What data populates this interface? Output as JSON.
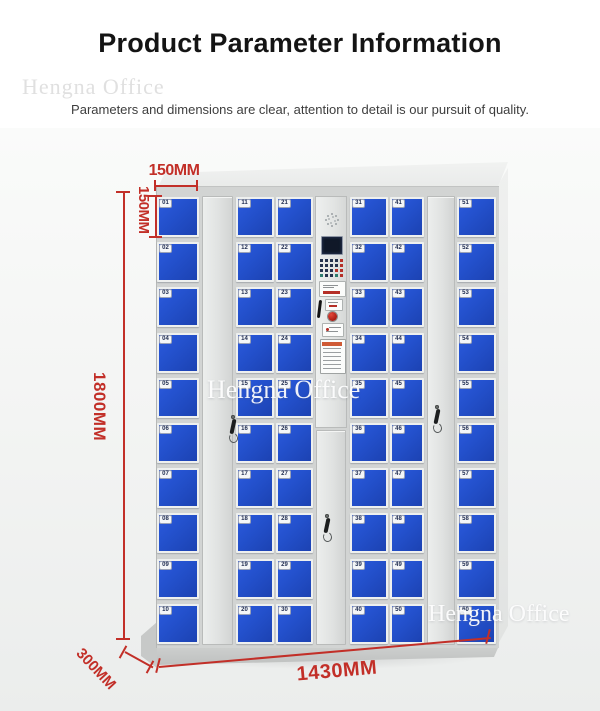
{
  "header": {
    "title": "Product Parameter Information",
    "subtitle": "Parameters and dimensions are clear, attention to detail is our pursuit of quality."
  },
  "watermarks": {
    "top_left": "Hengna Office",
    "center": "Hengna Office",
    "bottom_right": "Hengna Office"
  },
  "dimensions": {
    "door_width": "150MM",
    "door_height": "150MM",
    "height": "1800MM",
    "depth": "300MM",
    "width": "1430MM"
  },
  "colors": {
    "accent_red": "#c22f28",
    "door_blue": "#2350cb",
    "cabinet_gray": "#d2d4d3"
  },
  "locker": {
    "columns": [
      {
        "id": "c1",
        "type": "lockers",
        "numbers": [
          "01",
          "02",
          "03",
          "04",
          "05",
          "06",
          "07",
          "08",
          "09",
          "10"
        ]
      },
      {
        "id": "c2",
        "type": "tall-door"
      },
      {
        "id": "c3",
        "type": "lockers",
        "numbers": [
          "11",
          "12",
          "13",
          "14",
          "15",
          "16",
          "17",
          "18",
          "19",
          "20"
        ]
      },
      {
        "id": "c4",
        "type": "lockers",
        "numbers": [
          "21",
          "22",
          "23",
          "24",
          "25",
          "26",
          "27",
          "28",
          "29",
          "30"
        ]
      },
      {
        "id": "c5",
        "type": "control",
        "elements": [
          "speaker",
          "display",
          "keypad",
          "card-reader",
          "pen",
          "emergency-button",
          "info-label",
          "instruction-label",
          "lower-door",
          "key"
        ]
      },
      {
        "id": "c6",
        "type": "lockers",
        "numbers": [
          "31",
          "32",
          "33",
          "34",
          "35",
          "36",
          "37",
          "38",
          "39",
          "40"
        ]
      },
      {
        "id": "c7",
        "type": "lockers",
        "numbers": [
          "41",
          "42",
          "43",
          "44",
          "45",
          "46",
          "47",
          "48",
          "49",
          "50"
        ]
      },
      {
        "id": "c8",
        "type": "tall-door"
      },
      {
        "id": "c9",
        "type": "lockers",
        "numbers": [
          "51",
          "52",
          "53",
          "54",
          "55",
          "56",
          "57",
          "58",
          "59",
          "60"
        ]
      }
    ]
  }
}
